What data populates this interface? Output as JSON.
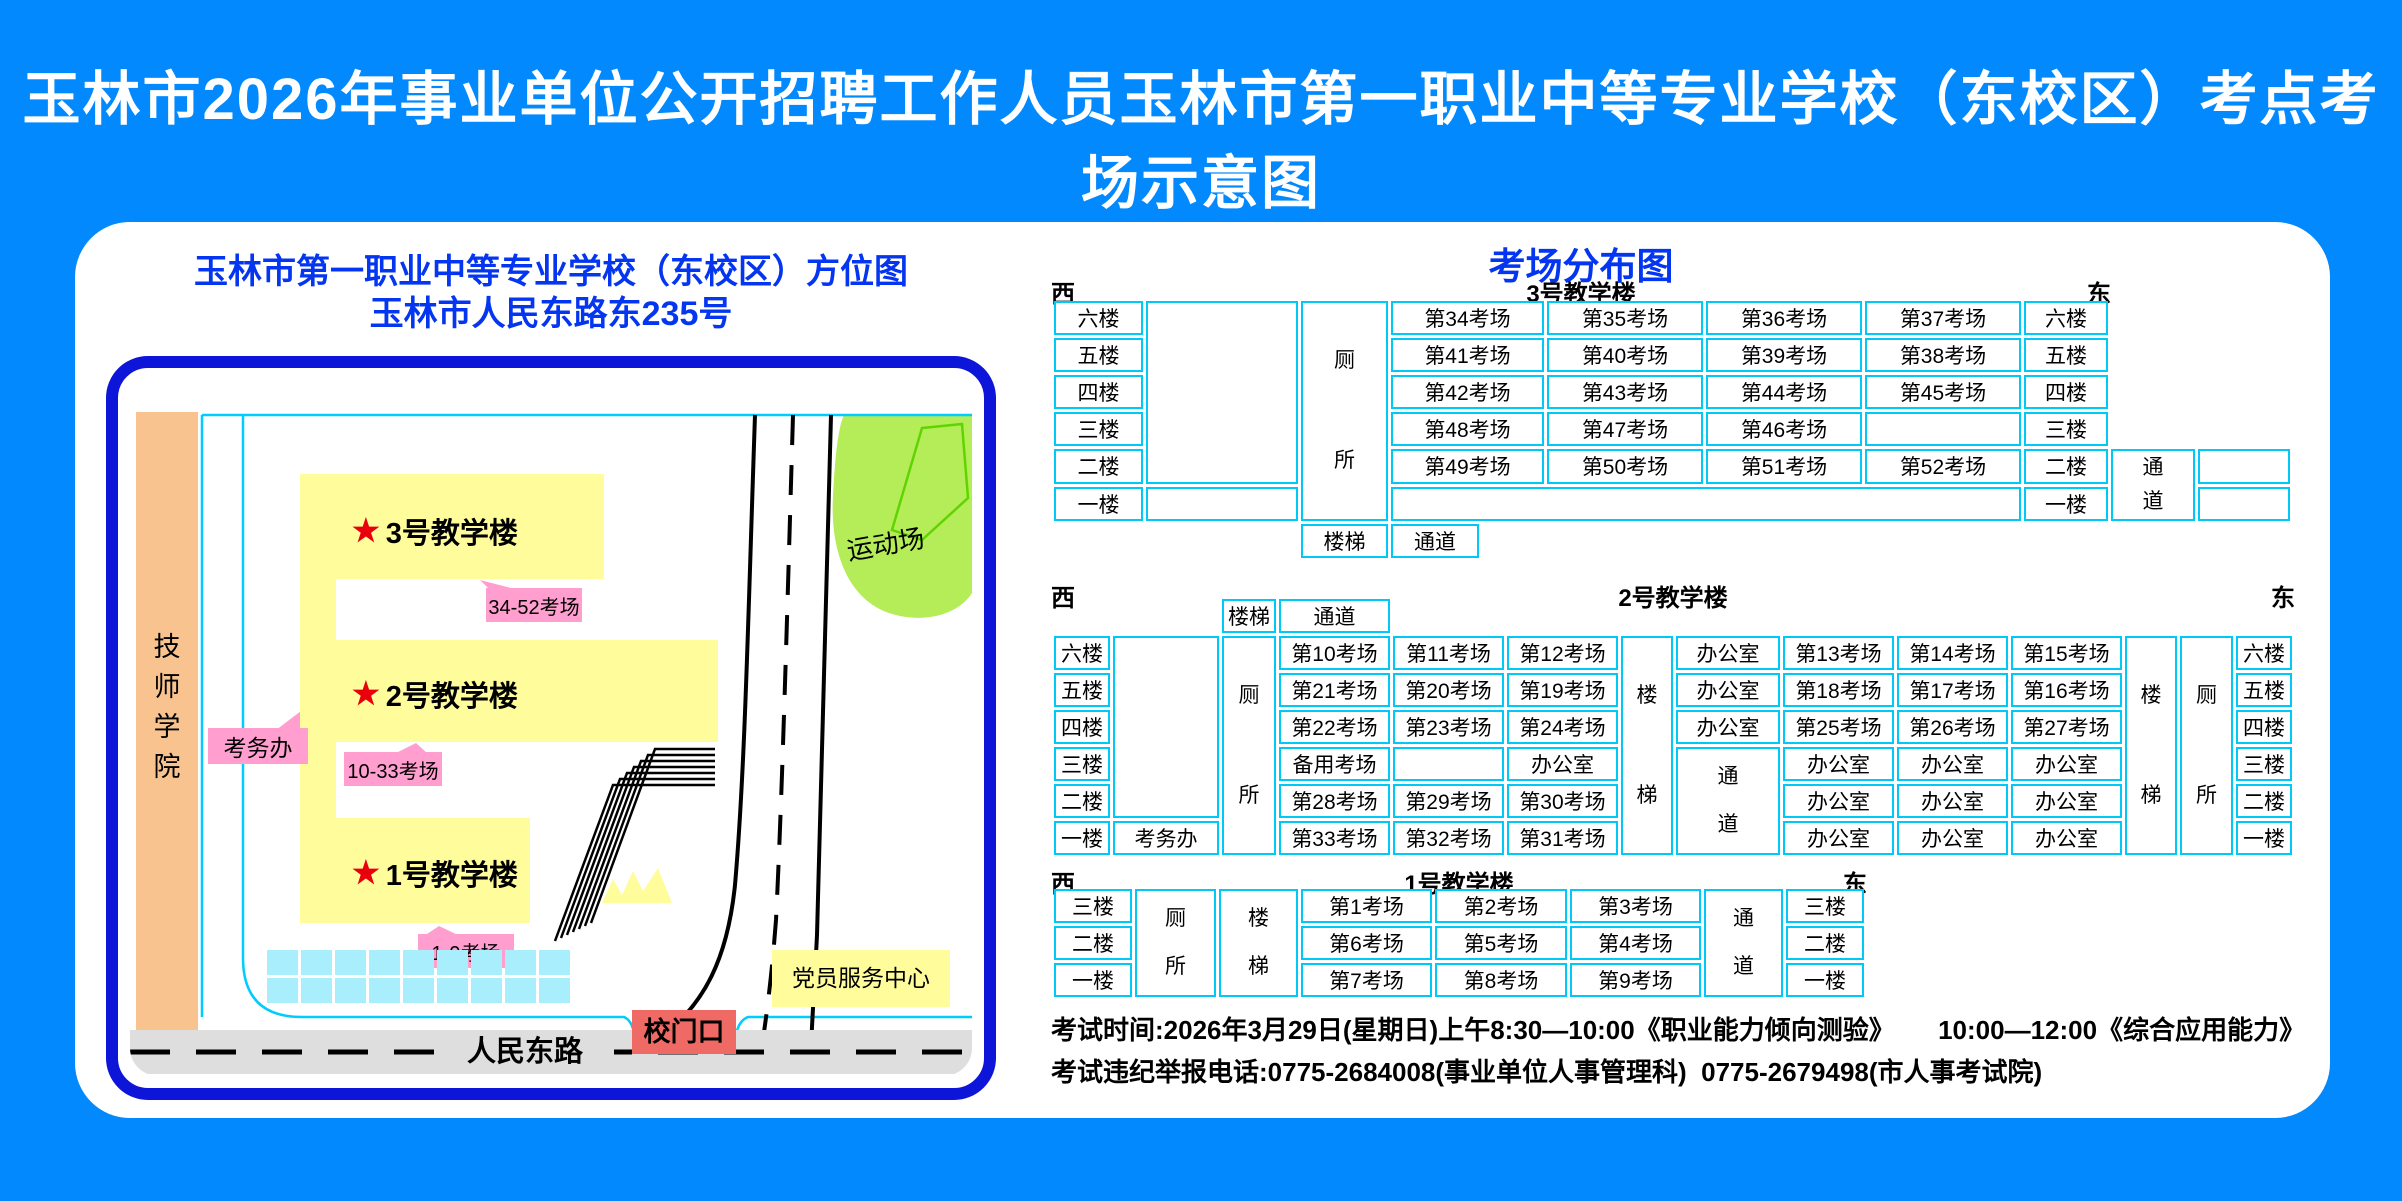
{
  "page_title": "玉林市2026年事业单位公开招聘工作人员玉林市第一职业中等专业学校（东校区）考点考场示意图",
  "colors": {
    "background": "#0289FE",
    "panel": "#FFFFFF",
    "map_border": "#0D15D8",
    "title_blue": "#0435F0",
    "cell_border_cyan": "#00C9F7",
    "building_yellow": "#FFFC9C",
    "callout_pink": "#FF9ECF",
    "star_red": "#E8000D",
    "gate_red": "#EF6A64",
    "neighbor_orange": "#F8C38F",
    "sports_green": "#B4ED58",
    "road_gray": "#DEDEDE",
    "parking_cyan": "#A9EEFC"
  },
  "map": {
    "title_line1": "玉林市第一职业中等专业学校（东校区）方位图",
    "title_line2": "玉林市人民东路东235号",
    "neighbor_label": "技师学院",
    "sports_field_label": "运动场",
    "road_label": "人民东路",
    "gate_label": "校门口",
    "party_center_label": "党员服务中心",
    "exam_office_label": "考务办",
    "buildings": [
      {
        "name": "3号教学楼",
        "rooms_label": "34-52考场"
      },
      {
        "name": "2号教学楼",
        "rooms_label": "10-33考场"
      },
      {
        "name": "1号教学楼",
        "rooms_label": "1-9考场"
      }
    ]
  },
  "distribution": {
    "title": "考场分布图",
    "west": "西",
    "east": "东",
    "tables": [
      {
        "name": "3号教学楼",
        "x": 976,
        "header_y": 52,
        "header_w": 1060,
        "table_y": 76,
        "col_widths": [
          89,
          152,
          87,
          88,
          62,
          156,
          156,
          156,
          84,
          84,
          92
        ],
        "row_heights": [
          33,
          33,
          33,
          33,
          33,
          33,
          28
        ],
        "rows": [
          [
            {
              "t": "六楼"
            },
            {
              "t": "",
              "rs": 5
            },
            {
              "t": "厕所",
              "rs": 6,
              "v": "v6"
            },
            {
              "t": "第34考场",
              "cs": 2
            },
            {
              "t": "第35考场"
            },
            {
              "t": "第36考场"
            },
            {
              "t": "第37考场"
            },
            {
              "t": "六楼"
            },
            {
              "b": 1
            },
            {
              "b": 1
            }
          ],
          [
            {
              "t": "五楼"
            },
            {
              "t": "第41考场",
              "cs": 2
            },
            {
              "t": "第40考场"
            },
            {
              "t": "第39考场"
            },
            {
              "t": "第38考场"
            },
            {
              "t": "五楼"
            },
            {
              "b": 1
            },
            {
              "b": 1
            }
          ],
          [
            {
              "t": "四楼"
            },
            {
              "t": "第42考场",
              "cs": 2
            },
            {
              "t": "第43考场"
            },
            {
              "t": "第44考场"
            },
            {
              "t": "第45考场"
            },
            {
              "t": "四楼"
            },
            {
              "b": 1
            },
            {
              "b": 1
            }
          ],
          [
            {
              "t": "三楼"
            },
            {
              "t": "第48考场",
              "cs": 2
            },
            {
              "t": "第47考场"
            },
            {
              "t": "第46考场"
            },
            {
              "t": ""
            },
            {
              "t": "三楼"
            },
            {
              "b": 1
            },
            {
              "b": 1
            }
          ],
          [
            {
              "t": "二楼"
            },
            {
              "t": "第49考场",
              "cs": 2
            },
            {
              "t": "第50考场"
            },
            {
              "t": "第51考场"
            },
            {
              "t": "第52考场"
            },
            {
              "t": "二楼"
            },
            {
              "t": "通道",
              "rs": 2,
              "v": "v2"
            },
            {
              "t": ""
            }
          ],
          [
            {
              "t": "一楼"
            },
            {
              "t": ""
            },
            {
              "t": "",
              "cs": 5
            },
            {
              "t": "一楼"
            },
            {
              "t": ""
            }
          ],
          [
            {
              "b": 1
            },
            {
              "b": 1
            },
            {
              "t": "楼梯"
            },
            {
              "t": "通道"
            },
            {
              "b": 1
            },
            {
              "b": 1
            },
            {
              "b": 1
            },
            {
              "b": 1
            },
            {
              "b": 1
            },
            {
              "b": 1
            }
          ]
        ]
      },
      {
        "name": "2号教学楼",
        "x": 976,
        "header_y": 356,
        "header_w": 1244,
        "table_y": 374,
        "col_widths": [
          56,
          106,
          54,
          111,
          111,
          111,
          52,
          104,
          111,
          111,
          111,
          52,
          53,
          56
        ],
        "row_heights": [
          26,
          33,
          33,
          33,
          33,
          33,
          33
        ],
        "rows": [
          [
            {
              "b": 1
            },
            {
              "b": 1
            },
            {
              "t": "楼梯"
            },
            {
              "t": "通道"
            },
            {
              "b": 1
            },
            {
              "b": 1
            },
            {
              "b": 1
            },
            {
              "b": 1
            },
            {
              "b": 1
            },
            {
              "b": 1
            },
            {
              "b": 1
            },
            {
              "b": 1
            },
            {
              "b": 1
            },
            {
              "b": 1
            }
          ],
          [
            {
              "t": "六楼"
            },
            {
              "t": "",
              "rs": 5
            },
            {
              "t": "厕所",
              "rs": 6,
              "v": "v6"
            },
            {
              "t": "第10考场"
            },
            {
              "t": "第11考场"
            },
            {
              "t": "第12考场"
            },
            {
              "t": "楼梯",
              "rs": 6,
              "v": "v6"
            },
            {
              "t": "办公室"
            },
            {
              "t": "第13考场"
            },
            {
              "t": "第14考场"
            },
            {
              "t": "第15考场"
            },
            {
              "t": "楼梯",
              "rs": 6,
              "v": "v6"
            },
            {
              "t": "厕所",
              "rs": 6,
              "v": "v6"
            },
            {
              "t": "六楼"
            }
          ],
          [
            {
              "t": "五楼"
            },
            {
              "t": "第21考场"
            },
            {
              "t": "第20考场"
            },
            {
              "t": "第19考场"
            },
            {
              "t": "办公室"
            },
            {
              "t": "第18考场"
            },
            {
              "t": "第17考场"
            },
            {
              "t": "第16考场"
            },
            {
              "t": "五楼"
            }
          ],
          [
            {
              "t": "四楼"
            },
            {
              "t": "第22考场"
            },
            {
              "t": "第23考场"
            },
            {
              "t": "第24考场"
            },
            {
              "t": "办公室"
            },
            {
              "t": "第25考场"
            },
            {
              "t": "第26考场"
            },
            {
              "t": "第27考场"
            },
            {
              "t": "四楼"
            }
          ],
          [
            {
              "t": "三楼"
            },
            {
              "t": "备用考场"
            },
            {
              "t": ""
            },
            {
              "t": "办公室"
            },
            {
              "t": "通道",
              "rs": 3,
              "v": "v3"
            },
            {
              "t": "办公室"
            },
            {
              "t": "办公室"
            },
            {
              "t": "办公室"
            },
            {
              "t": "三楼"
            }
          ],
          [
            {
              "t": "二楼"
            },
            {
              "t": "第28考场"
            },
            {
              "t": "第29考场"
            },
            {
              "t": "第30考场"
            },
            {
              "t": "办公室"
            },
            {
              "t": "办公室"
            },
            {
              "t": "办公室"
            },
            {
              "t": "二楼"
            }
          ],
          [
            {
              "t": "一楼"
            },
            {
              "t": "考务办"
            },
            {
              "t": "第33考场"
            },
            {
              "t": "第32考场"
            },
            {
              "t": "第31考场"
            },
            {
              "t": "办公室"
            },
            {
              "t": "办公室"
            },
            {
              "t": "办公室"
            },
            {
              "t": "一楼"
            }
          ]
        ]
      },
      {
        "name": "1号教学楼",
        "x": 976,
        "header_y": 642,
        "header_w": 816,
        "table_y": 664,
        "col_widths": [
          78,
          81,
          79,
          131,
          132,
          131,
          79,
          78
        ],
        "row_heights": [
          33,
          33,
          33
        ],
        "rows": [
          [
            {
              "t": "三楼"
            },
            {
              "t": "厕所",
              "rs": 3,
              "v": "v3"
            },
            {
              "t": "楼梯",
              "rs": 3,
              "v": "v3"
            },
            {
              "t": "第1考场"
            },
            {
              "t": "第2考场"
            },
            {
              "t": "第3考场"
            },
            {
              "t": "通道",
              "rs": 3,
              "v": "v3"
            },
            {
              "t": "三楼"
            }
          ],
          [
            {
              "t": "二楼"
            },
            {
              "t": "第6考场"
            },
            {
              "t": "第5考场"
            },
            {
              "t": "第4考场"
            },
            {
              "t": "二楼"
            }
          ],
          [
            {
              "t": "一楼"
            },
            {
              "t": "第7考场"
            },
            {
              "t": "第8考场"
            },
            {
              "t": "第9考场"
            },
            {
              "t": "一楼"
            }
          ]
        ]
      }
    ]
  },
  "footer": {
    "line1": "考试时间:2026年3月29日(星期日)上午8:30—10:00《职业能力倾向测验》      10:00—12:00《综合应用能力》",
    "line2": "考试违纪举报电话:0775-2684008(事业单位人事管理科)  0775-2679498(市人事考试院)"
  }
}
